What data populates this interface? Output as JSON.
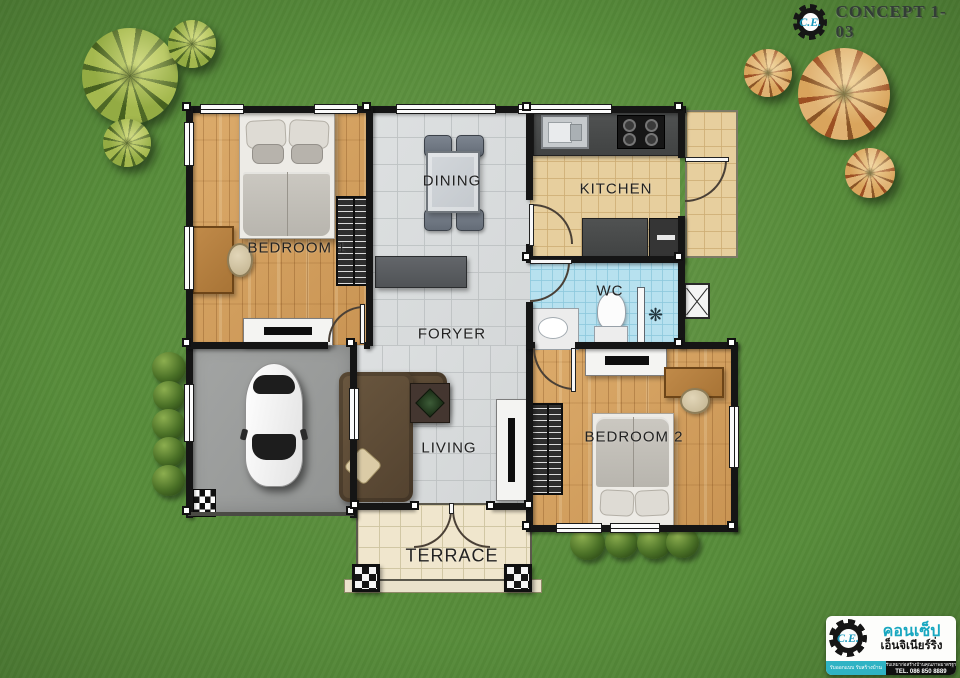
{
  "header": {
    "brand": "C.E.",
    "title": "CONCEPT 1-03"
  },
  "rooms": {
    "bedroom1": "BEDROOM 1",
    "dining": "DINING",
    "kitchen": "KITCHEN",
    "wc": "WC",
    "foyer": "FORYER",
    "living": "LIVING",
    "bedroom2": "BEDROOM 2",
    "terrace": "TERRACE"
  },
  "footer": {
    "brand": "C.E.",
    "company_line1": "คอนเซ็ป",
    "company_line2": "เอ็นจิเนียร์ริ่ง",
    "tagline": "รับออกแบบ รับสร้างบ้าน",
    "services": "รับเหมาก่อสร้างบ้านคุณภาพมาตรฐาน",
    "tel": "TEL. 086 850 8889"
  },
  "colors": {
    "grass": "#578c3a",
    "wall": "#151515",
    "wood_floor": "#d2a05f",
    "tile_grey": "#d7dadb",
    "tile_kitchen": "#e7cf9e",
    "tile_wc": "#b7e1ef",
    "tile_terrace": "#f0e6cd",
    "garage_concrete": "#9a9c9b",
    "accent_teal": "#18a7c0"
  }
}
